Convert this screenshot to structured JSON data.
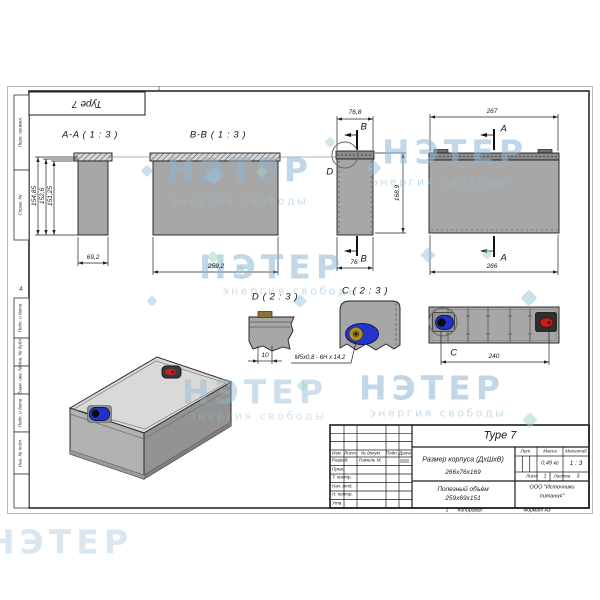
{
  "watermark": {
    "brand": "НЭТЕР",
    "tagline": "энергия свободы"
  },
  "frame": {
    "zone_top": "1",
    "zone_left": "А",
    "zone_bottom": "1",
    "stamp_repeat": "Type 7",
    "side_labels": [
      "Перв. примен.",
      "Справ. №",
      "Подп. и дата",
      "Инв. № дубл.",
      "Взам. инв. №",
      "Подп. и дата",
      "Инв. № подл."
    ]
  },
  "views": {
    "aa": {
      "label": "A-A ( 1 : 3 )",
      "h1": "154,85",
      "h2": "152,6",
      "h3": "151,25",
      "w": "69,2"
    },
    "bb": {
      "label": "B-B ( 1 : 3 )",
      "w": "259,2"
    },
    "side": {
      "top": "76,8",
      "bottom": "76",
      "height": "168,9",
      "cut": "B",
      "detail": "D"
    },
    "front": {
      "top": "267",
      "bottom": "266",
      "cut": "A"
    },
    "detail_d": {
      "label": "D ( 2 : 3 )",
      "dim": "10"
    },
    "detail_c": {
      "label": "C ( 2 : 3 )",
      "thread": "M5x0,8 - 6H x 14,2"
    },
    "top_view": {
      "dim": "240",
      "detail": "C"
    }
  },
  "titleblock": {
    "doc": "Type 7",
    "cols": [
      "Изм.",
      "Лист",
      "№ докум.",
      "Подп.",
      "Дата"
    ],
    "r1": "Разраб.",
    "r1name": "Рамиль М.",
    "r2": "Пров.",
    "r3": "Т. контр.",
    "r4": "Нач. отд.",
    "r5": "Н. контр.",
    "r6": "Утв.",
    "title1": "Размер корпуса (ДхШхВ)",
    "title1b": "266x76x169",
    "title2": "Полезный объём",
    "title2b": "259x69x151",
    "lit": "Лит.",
    "mass": "Масса",
    "scale": "Масштаб",
    "mass_v": "0,49 кг",
    "scale_v": "1 : 3",
    "sheet": "Лист",
    "sheet_v": "1",
    "sheets": "Листов",
    "sheets_v": "3",
    "company1": "ООО \"Источники",
    "company2": "питания\"",
    "copied": "Копировал",
    "format": "Формат А3",
    "margin_num": "1"
  }
}
